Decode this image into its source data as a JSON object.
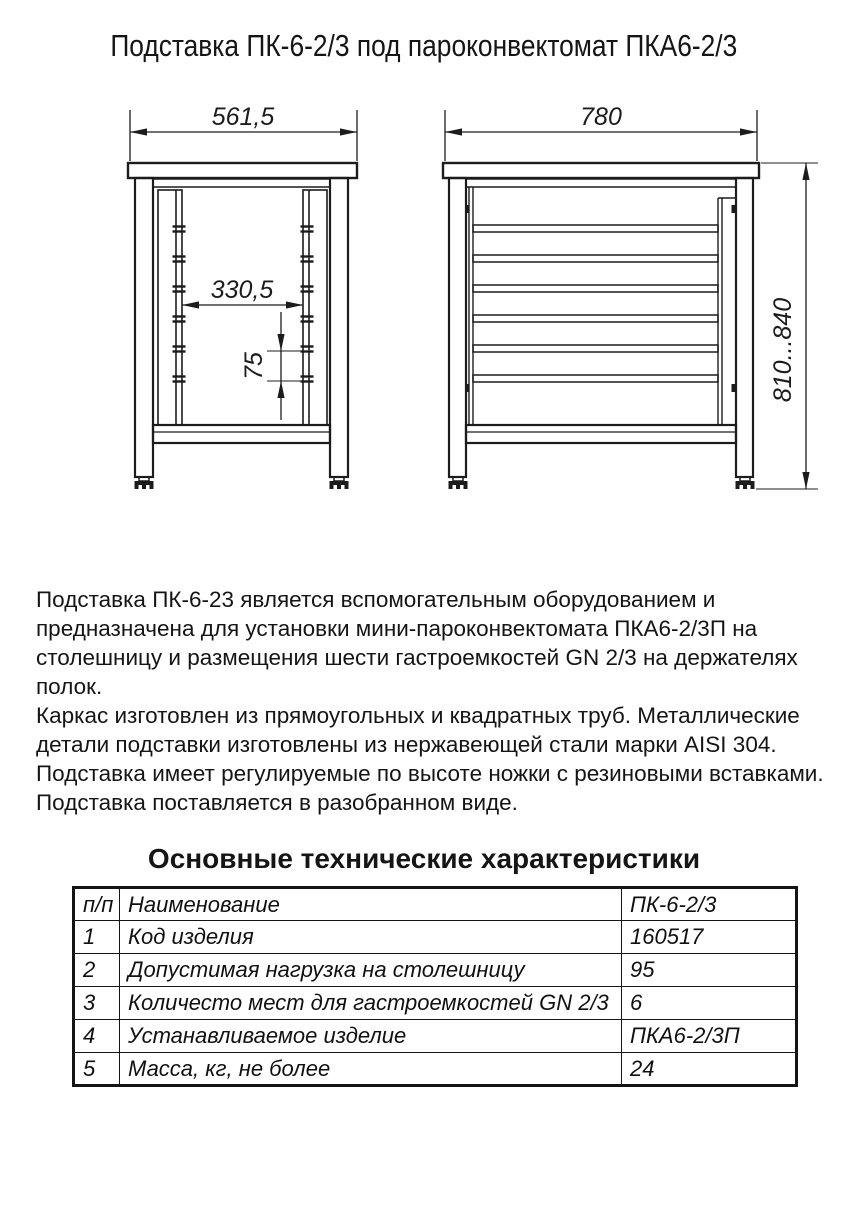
{
  "title": "Подставка ПК-6-2/3 под пароконвектомат ПКА6-2/3",
  "drawing": {
    "front_view": {
      "top_width": "561,5",
      "rail_spacing": "330,5",
      "shelf_pitch": "75"
    },
    "side_view": {
      "top_depth": "780",
      "height_range": "810...840"
    }
  },
  "description": {
    "lines": [
      "Подставка ПК-6-23 является вспомогательным оборудованием и",
      "предназначена для установки мини-пароконвектомата ПКА6-2/3П на",
      "столешницу и размещения шести гастроемкостей GN 2/3 на держателях",
      "полок.",
      "Каркас изготовлен из прямоугольных и квадратных труб. Металлические",
      "детали подставки изготовлены из нержавеющей стали марки AISI 304.",
      "Подставка имеет регулируемые по высоте ножки с резиновыми вставками.",
      "Подставка поставляется в разобранном виде."
    ]
  },
  "specs": {
    "heading": "Основные технические характеристики",
    "table": {
      "header": {
        "num": "п/п",
        "name": "Наименование",
        "value": "ПК-6-2/3"
      },
      "rows": [
        {
          "num": "1",
          "name": "Код изделия",
          "value": "160517"
        },
        {
          "num": "2",
          "name": "Допустимая нагрузка на столешницу",
          "value": "95"
        },
        {
          "num": "3",
          "name": "Количесто мест для гастроемкостей GN 2/3",
          "value": "6"
        },
        {
          "num": "4",
          "name": "Устанавливаемое изделие",
          "value": "ПКА6-2/3П"
        },
        {
          "num": "5",
          "name": "Масса, кг, не более",
          "value": "24"
        }
      ]
    }
  },
  "colors": {
    "line": "#1c1c1c",
    "background": "#ffffff"
  }
}
